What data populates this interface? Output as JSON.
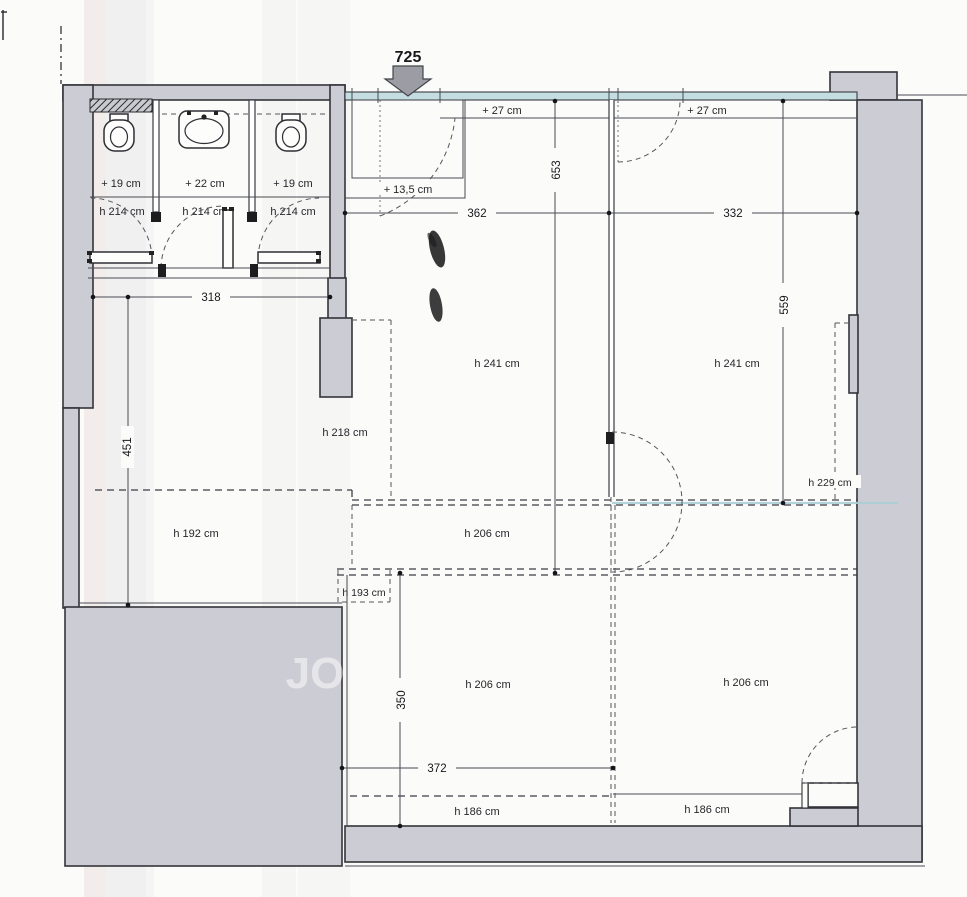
{
  "entrance": {
    "width_label": "725"
  },
  "ceiling_offsets": {
    "left_strip": "+ 27 cm",
    "right_strip": "+ 27 cm",
    "entrance_zone": "+ 13,5 cm"
  },
  "stalls": [
    {
      "floor_offset": "+ 19 cm",
      "height": "h 214 cm",
      "fixture": "toilet"
    },
    {
      "floor_offset": "+ 22 cm",
      "height": "h 214 cm",
      "fixture": "sink"
    },
    {
      "floor_offset": "+ 19 cm",
      "height": "h 214 cm",
      "fixture": "toilet"
    }
  ],
  "dims": {
    "stall_row_width": "318",
    "top_left_width": "362",
    "top_right_width": "332",
    "left_height": "451",
    "center_height": "653",
    "right_height": "559",
    "bottom_height": "350",
    "bottom_width": "372"
  },
  "rooms": {
    "center_top": "h 241 cm",
    "right_top": "h 241 cm",
    "left_upper_zone": "h 218 cm",
    "left_room": "h 192 cm",
    "mid_band": "h 206 cm",
    "bottom_center": "h 206 cm",
    "bottom_right": "h 206 cm",
    "right_wall_niche": "h 229 cm",
    "small_niche": "h 193 cm",
    "bottom_strip_left": "h 186 cm",
    "bottom_strip_right": "h 186 cm"
  },
  "watermark": "JO",
  "colors": {
    "paper": "#fbfbf9",
    "wall_fill": "#cccdd4",
    "glazing_fill": "#c3dde1",
    "arrow_fill": "#9b9ca4"
  }
}
